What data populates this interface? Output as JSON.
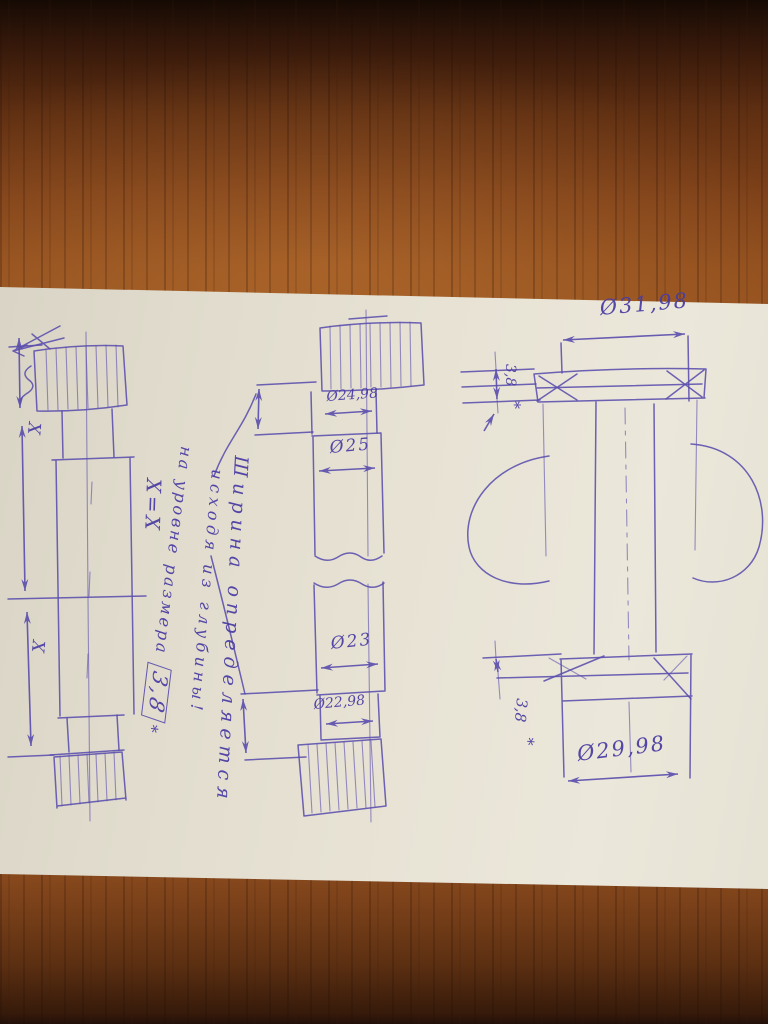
{
  "note": {
    "line1": "Ширина определяется",
    "line2": "исходя из глубины!",
    "line3": "на уровне размера",
    "boxed_value": "3,8",
    "footnote_mark": "*"
  },
  "left_view": {
    "dim_upper": "X",
    "dim_lower": "X",
    "equality": "X=X"
  },
  "middle_view": {
    "dia_1": "Ø24,98",
    "dia_2": "Ø25",
    "dia_3": "Ø23",
    "dia_4": "Ø22,98"
  },
  "right_view": {
    "dia_top": "Ø31,98",
    "thk_top": "3,8",
    "thk_top_mark": "*",
    "dia_bottom": "Ø29,98",
    "thk_bottom": "3,8",
    "thk_bottom_mark": "*"
  }
}
